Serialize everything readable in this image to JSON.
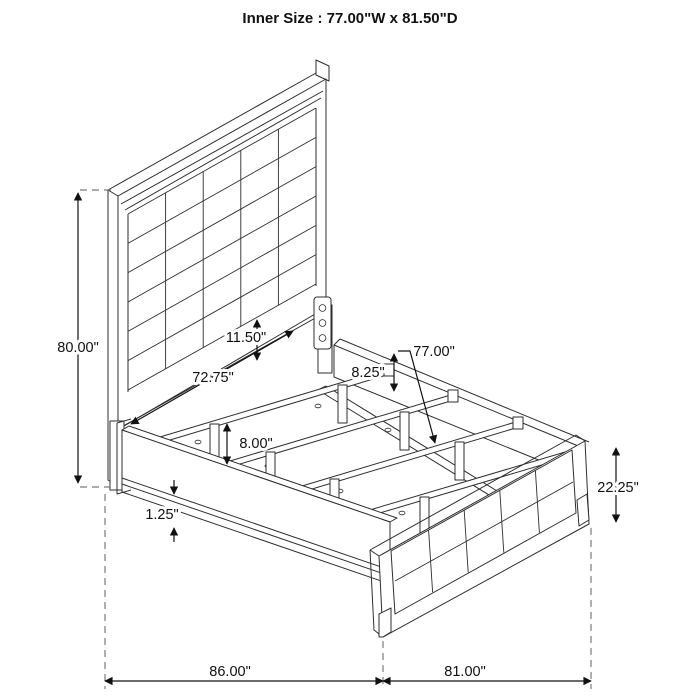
{
  "title": "Inner Size : 77.00\"W x 81.50\"D",
  "dimensions": {
    "headboard_height": "80.00\"",
    "panel_band_height": "11.50\"",
    "cleat_length": "72.75\"",
    "side_rail_height": "8.25\"",
    "slat_length": "77.00\"",
    "slat_leg_height": "8.00\"",
    "rail_lip_thickness": "1.25\"",
    "footboard_height": "22.25\"",
    "overall_length": "86.00\"",
    "overall_width": "81.00\""
  }
}
